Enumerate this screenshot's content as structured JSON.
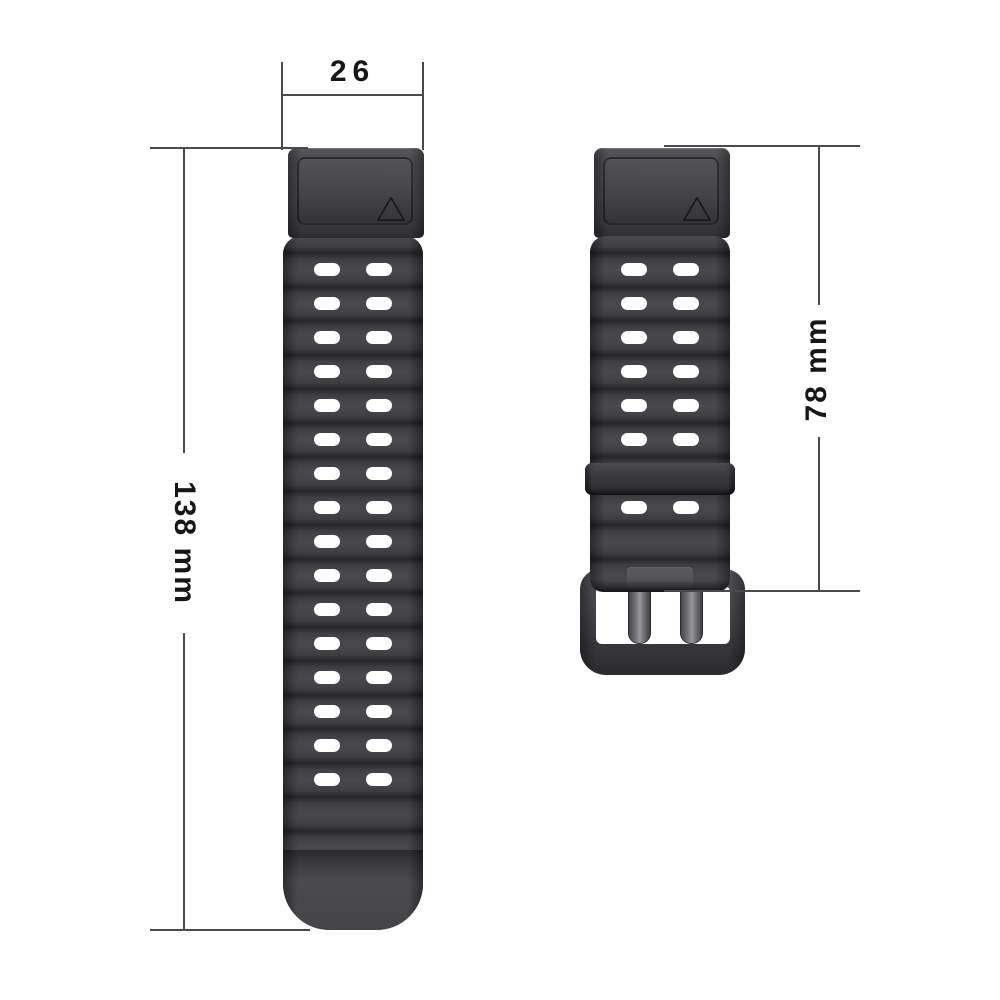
{
  "dimensions": {
    "width_label": "26",
    "length_label": "138 mm",
    "buckle_length_label": "78 mm"
  },
  "straps": {
    "long": {
      "hole_rows": 16,
      "hole_cols": 2
    },
    "short": {
      "visible_hole_rows": [
        0,
        1,
        2,
        3,
        4,
        5,
        7
      ],
      "hole_cols": 2,
      "has_keeper": true,
      "has_buckle": true
    }
  },
  "marks": {
    "connector_triangle": "triangle-outline"
  },
  "colors": {
    "background": "#ffffff",
    "band_base": "#3e3e42",
    "band_light": "#48484c",
    "band_crease": "#26262a",
    "hole": "#ffffff",
    "dimension_line": "#4a4a4a",
    "dimension_text": "#161616",
    "buckle_highlight": "#96969b"
  }
}
